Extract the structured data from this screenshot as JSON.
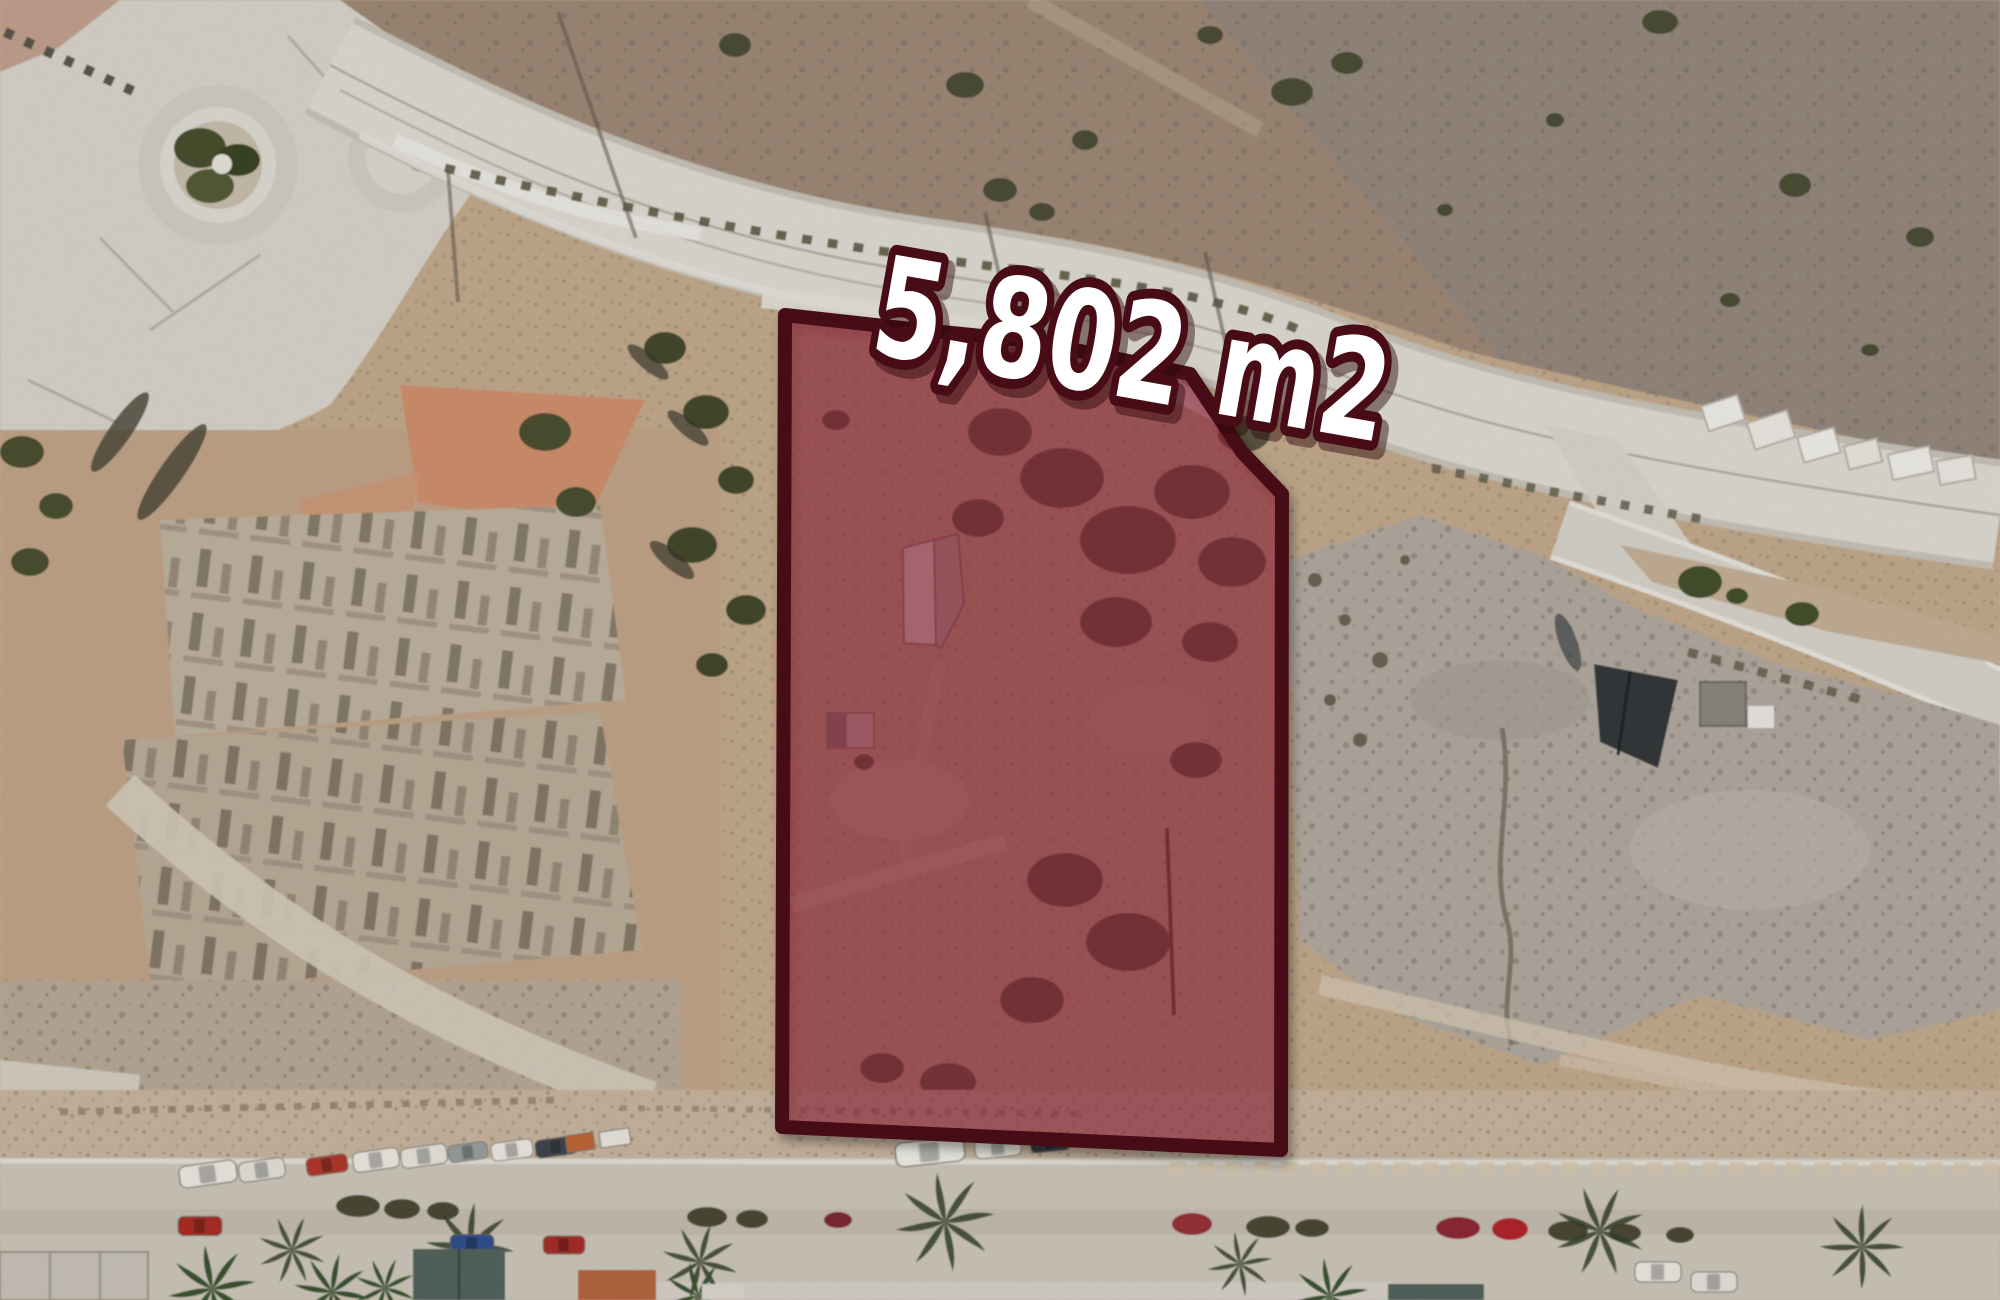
{
  "map": {
    "kind": "satellite-aerial-view",
    "parcel": {
      "area_label": "5,802 m2",
      "polygon_points": "785,315 902,328 1032,341 1190,374 1242,452 1282,494 1281,1150 782,1127",
      "fill_color": "#8e1f38",
      "fill_opacity": "0.52",
      "outline_color": "#470c15",
      "outline_width": "14",
      "label_fill": "#ffffff",
      "label_outline": "#470c15"
    }
  }
}
